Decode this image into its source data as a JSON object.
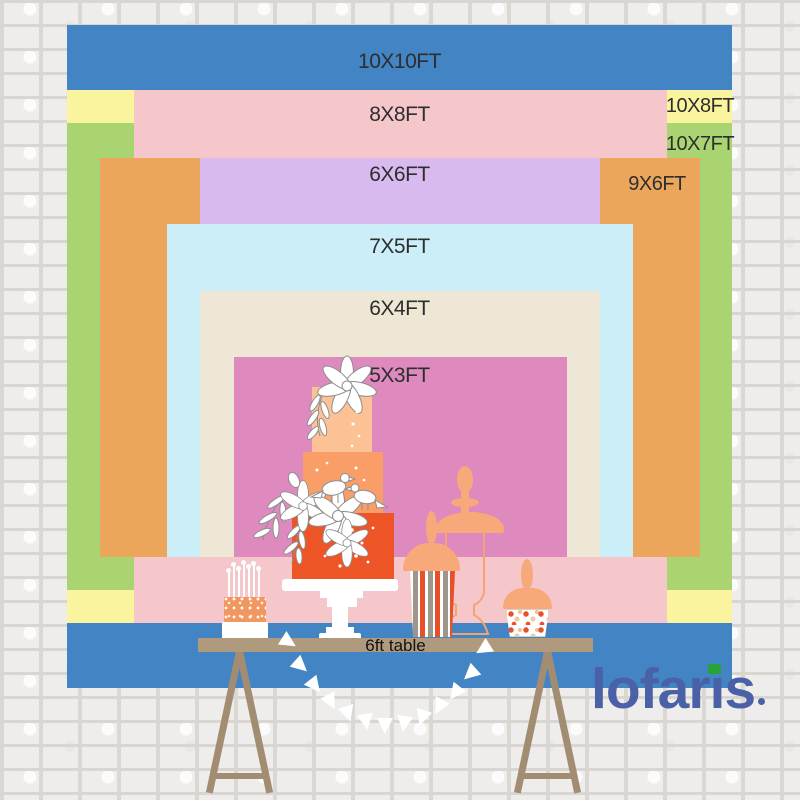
{
  "chart": {
    "title": "backdrop size comparison",
    "sizes": [
      {
        "id": "10x10",
        "label": "10X10FT",
        "color": "#4284c4"
      },
      {
        "id": "10x8",
        "label": "10X8FT",
        "color": "#faf49e"
      },
      {
        "id": "10x7",
        "label": "10X7FT",
        "color": "#a9d471"
      },
      {
        "id": "8x8",
        "label": "8X8FT",
        "color": "#f5c7cb"
      },
      {
        "id": "9x6",
        "label": "9X6FT",
        "color": "#eba65c"
      },
      {
        "id": "6x6",
        "label": "6X6FT",
        "color": "#d9baee"
      },
      {
        "id": "7x5",
        "label": "7X5FT",
        "color": "#cceef8"
      },
      {
        "id": "6x4",
        "label": "6X4FT",
        "color": "#eee7d5"
      },
      {
        "id": "5x3",
        "label": "5X3FT",
        "color": "#de8abf"
      }
    ],
    "table_label": "6ft table",
    "label_color": "#2e2e2e"
  },
  "brand": {
    "name": "lofaris",
    "color": "#4a61a8",
    "accent_green": "#27a23c"
  }
}
